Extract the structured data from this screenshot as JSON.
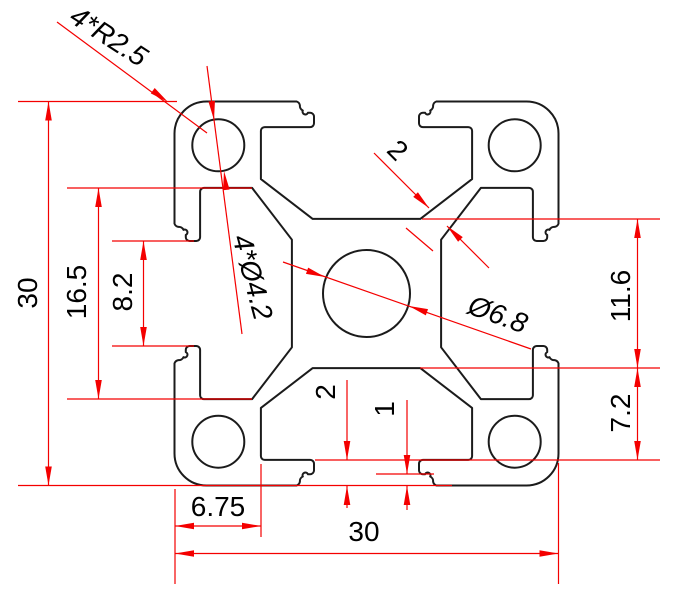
{
  "drawing": {
    "kind": "technical-dimension-drawing",
    "subject": "30x30 aluminium extrusion profile cross-section",
    "labels": {
      "corner_radius": "4*R2.5",
      "web_thickness": "2",
      "overall_height": "30",
      "cavity_width": "16.5",
      "slot_opening": "8.2",
      "corner_holes": "4*Ø4.2",
      "center_hole": "Ø6.8",
      "lip_to_lip": "11.6",
      "cavity_depth": "7.2",
      "edge_to_cavity": "6.75",
      "lip_thickness": "2",
      "notch_offset": "1",
      "overall_width": "30"
    },
    "colors": {
      "profile": "#1b1b1b",
      "dimension": "#f40000",
      "text": "#000000",
      "background": "#ffffff"
    }
  }
}
